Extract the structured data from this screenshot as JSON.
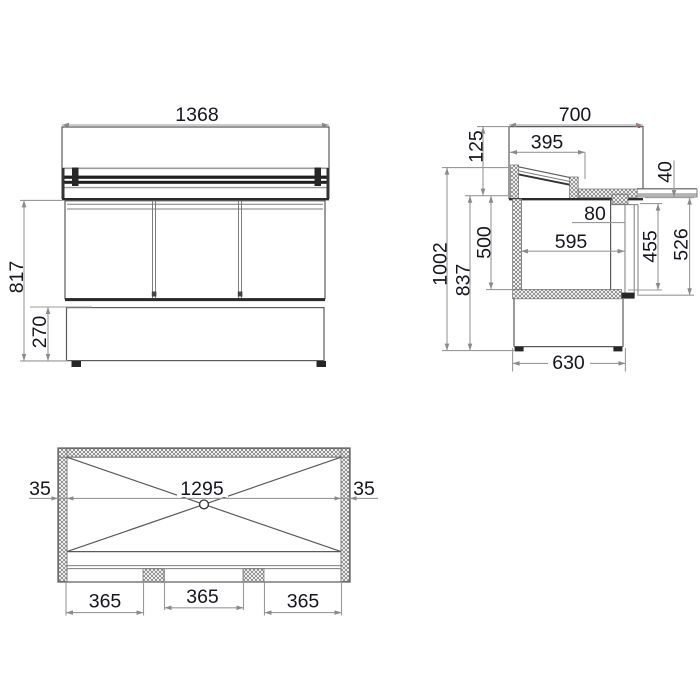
{
  "colors": {
    "background": "#ffffff",
    "object_line": "#5a5a5a",
    "dimension_line": "#999999",
    "dark_fill": "#1f1f1f",
    "text": "#15151f",
    "artifact_red": "#e23b2e"
  },
  "front_view": {
    "overall_width_mm": "1368",
    "worktop_height_mm": "817",
    "base_height_mm": "270"
  },
  "side_view": {
    "overall_depth_mm": "700",
    "lid_depth_mm": "395",
    "lid_rise_mm": "125",
    "counter_thickness_mm": "40",
    "rail_depth_mm": "80",
    "chamber_depth_mm": "595",
    "door_opening_mm": "455",
    "door_height_mm": "526",
    "chamber_height_mm": "500",
    "worktop_height_mm": "837",
    "overall_height_mm": "1002",
    "base_depth_mm": "630"
  },
  "plan_view": {
    "rim_left_mm": "35",
    "opening_width_mm": "1295",
    "rim_right_mm": "35",
    "board_left_mm": "365",
    "board_center_mm": "365",
    "board_right_mm": "365"
  }
}
